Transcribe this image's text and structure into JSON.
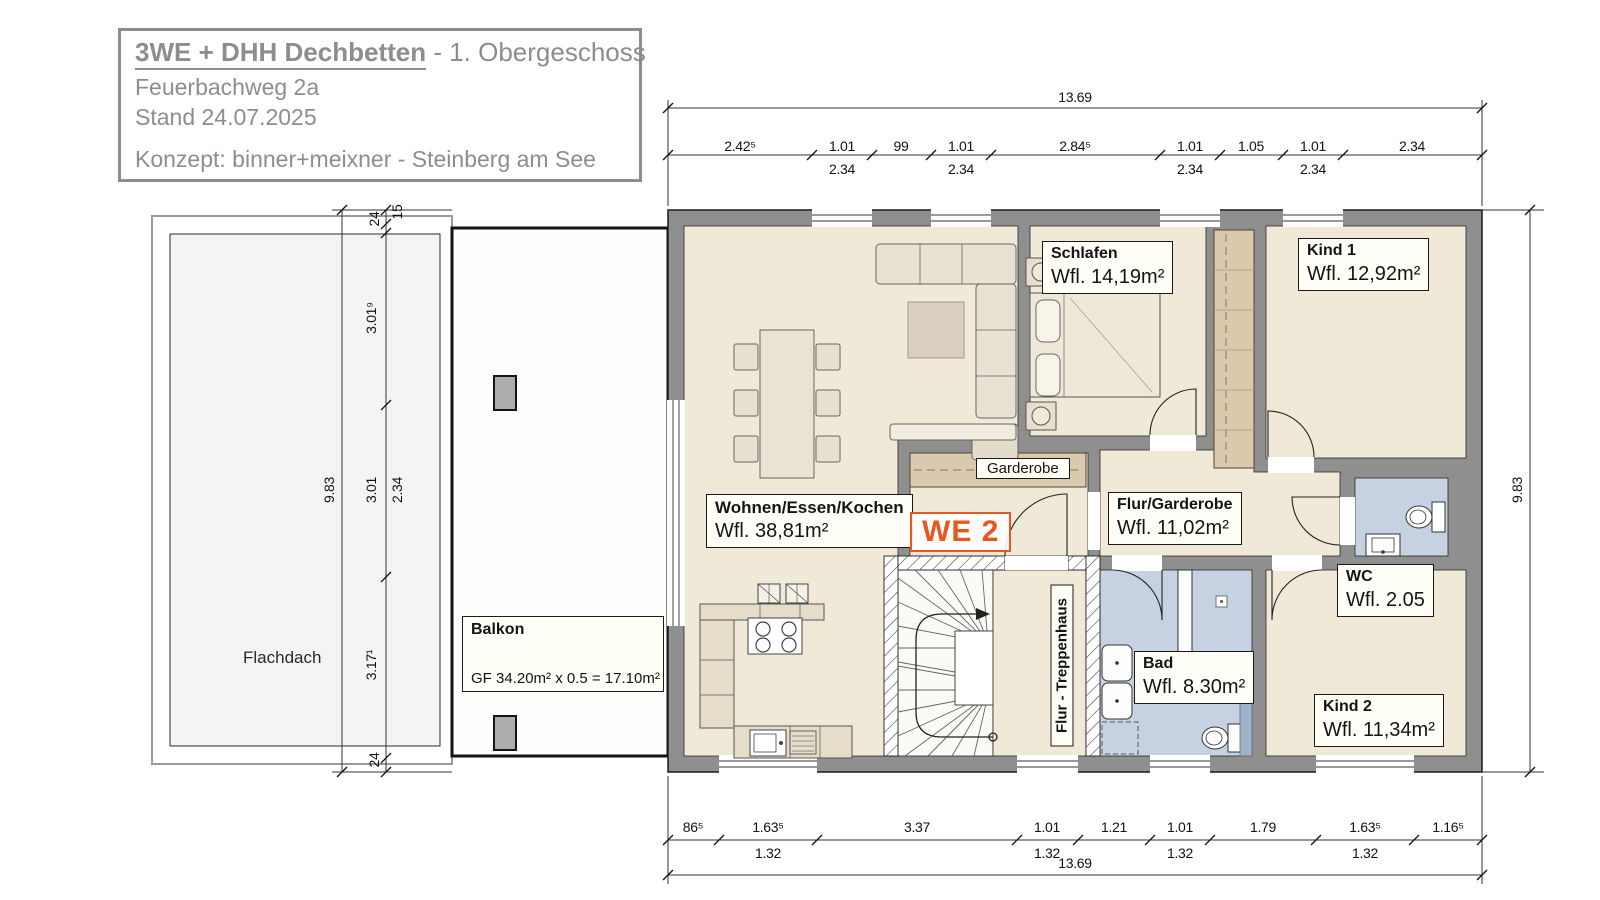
{
  "title_block": {
    "project": "3WE + DHH Dechbetten",
    "suffix": " - 1. Obergeschoss",
    "address": "Feuerbachweg 2a",
    "status": "Stand 24.07.2025",
    "concept": "Konzept: binner+meixner - Steinberg am See"
  },
  "unit": {
    "label": "WE 2",
    "accent_color": "#e8571c"
  },
  "rooms": {
    "schlafen": {
      "name": "Schlafen",
      "area": "Wfl. 14,19m²"
    },
    "kind1": {
      "name": "Kind 1",
      "area": "Wfl. 12,92m²"
    },
    "wohnen": {
      "name": "Wohnen/Essen/Kochen",
      "area": "Wfl. 38,81m²"
    },
    "flur": {
      "name": "Flur/Garderobe",
      "area": "Wfl. 11,02m²"
    },
    "wc": {
      "name": "WC",
      "area": "Wfl. 2.05"
    },
    "bad": {
      "name": "Bad",
      "area": "Wfl. 8.30m²"
    },
    "kind2": {
      "name": "Kind 2",
      "area": "Wfl. 11,34m²"
    },
    "garderobe": {
      "name": "Garderobe"
    },
    "treppenhaus": {
      "name": "Flur - Treppenhaus"
    },
    "flachdach": {
      "name": "Flachdach"
    },
    "balkon": {
      "name": "Balkon",
      "formula": "GF 34.20m² x 0.5 = 17.10m²"
    }
  },
  "dimensions": {
    "top_total": "13.69",
    "bottom_total": "13.69",
    "left_total": "9.83",
    "right_total": "9.83",
    "top_chain": [
      "2.42⁵",
      "1.01",
      "99",
      "1.01",
      "2.84⁵",
      "1.01",
      "1.05",
      "1.01",
      "2.34"
    ],
    "top_sub": [
      "2.34",
      "2.34",
      "2.34",
      "2.34"
    ],
    "bottom_chain": [
      "86⁵",
      "1.63⁵",
      "3.37",
      "1.01",
      "1.21",
      "1.01",
      "1.79",
      "1.63⁵",
      "1.16⁵"
    ],
    "bottom_sub": [
      "1.32",
      "1.32",
      "1.32",
      "1.32"
    ],
    "left_chain": [
      "24",
      "15",
      "3.01⁹",
      "3.01",
      "2.34",
      "3.17¹",
      "24"
    ]
  },
  "colors": {
    "wall_gray": "#8f8f8f",
    "floor_beige": "#f1e9d7",
    "wet_room_blue": "#c6d1e2",
    "wood_tan": "#dbc9ae",
    "accent_orange": "#e8571c"
  }
}
